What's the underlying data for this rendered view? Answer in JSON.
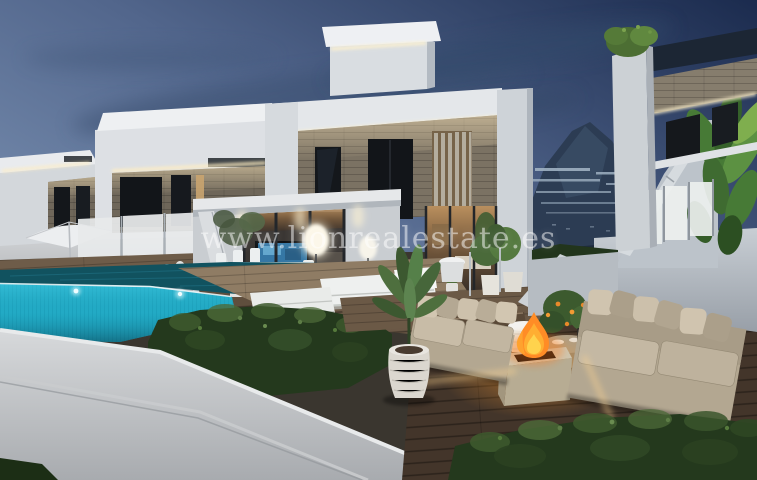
{
  "watermark": {
    "text": "www.lionrealestate.es"
  },
  "scene": {
    "type": "3d-architectural-render",
    "setting": "modern white villas at dusk",
    "elements": [
      "dusk sky with clouds",
      "mountain with hillside apartments",
      "two background villas",
      "main villa with stone cladding and LED strips",
      "covered porch with dining set",
      "TV with blue screen",
      "floor lamps",
      "infinity pool with underwater lights",
      "wooden pool deck",
      "white sun loungers",
      "boxwood hedges",
      "white boundary wall",
      "outdoor lounge deck",
      "two beige sofas",
      "square fire pit with flames",
      "round stone coffee table",
      "woven planter",
      "potted palm",
      "citrus tree",
      "glass railings",
      "parasol",
      "right villa with banana plants",
      "flying bird"
    ]
  },
  "palette": {
    "sky_light": "#6f86a8",
    "sky_dark": "#1d2d50",
    "cloud": "#3a4f70",
    "mountain": "#2c3c53",
    "villa_white": "#dfe2e6",
    "stone_cladding": "#7b7263",
    "window_dark": "#14171b",
    "warm_light": "#b98f5e",
    "led_glow": "#ffeec2",
    "pool_turquoise": "#24aec9",
    "pool_surface": "#11525f",
    "deck_wood": "#8f7c64",
    "lounge_floor": "#43352a",
    "hedge_green": "#24391d",
    "sofa_beige": "#b3a791",
    "fire_orange": "#ff8c26",
    "fire_core": "#ffd34d",
    "watermark_white": "rgba(255,255,255,0.5)"
  }
}
